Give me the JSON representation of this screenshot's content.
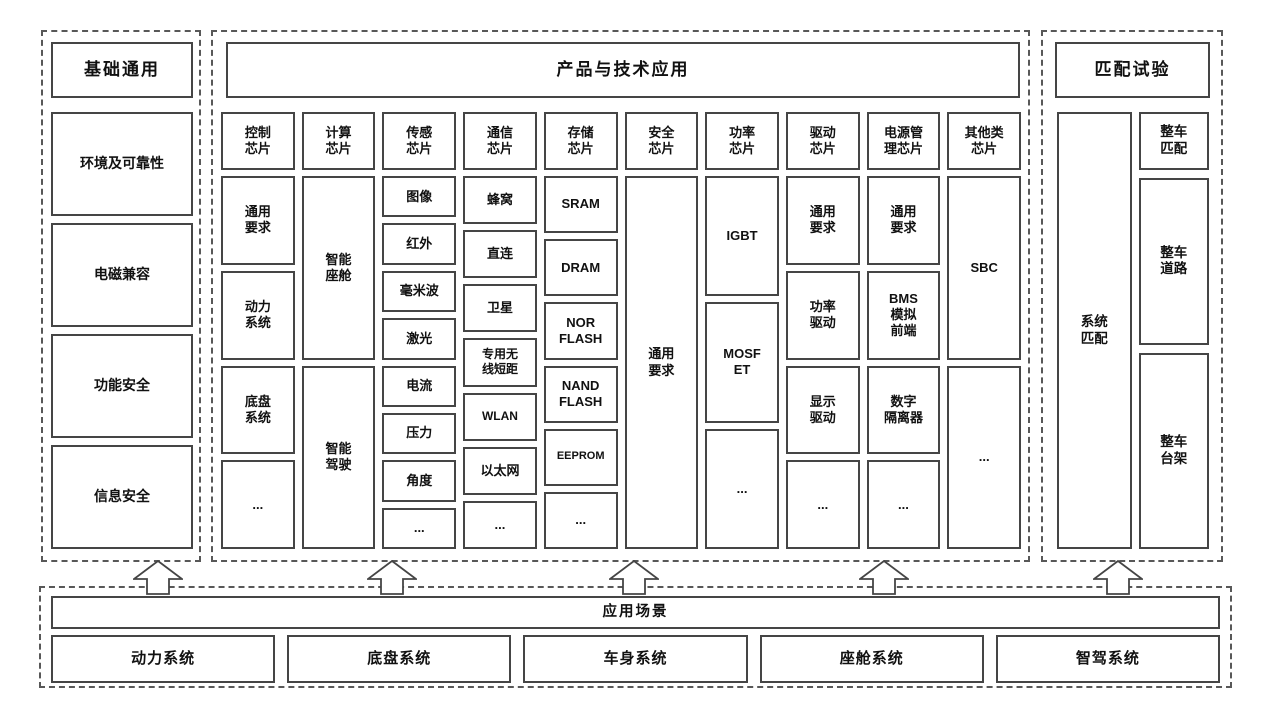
{
  "base": {
    "title": "基础通用",
    "items": [
      "环境及可靠性",
      "电磁兼容",
      "功能安全",
      "信息安全"
    ]
  },
  "products": {
    "title": "产品与技术应用",
    "columns": [
      {
        "header": "控制\n芯片",
        "items": [
          "通用\n要求",
          "动力\n系统",
          "底盘\n系统",
          "..."
        ]
      },
      {
        "header": "计算\n芯片",
        "items": [
          "智能\n座舱",
          "智能\n驾驶"
        ]
      },
      {
        "header": "传感\n芯片",
        "items": [
          "图像",
          "红外",
          "毫米波",
          "激光",
          "电流",
          "压力",
          "角度",
          "..."
        ]
      },
      {
        "header": "通信\n芯片",
        "items": [
          "蜂窝",
          "直连",
          "卫星",
          "专用无\n线短距",
          "WLAN",
          "以太网",
          "..."
        ]
      },
      {
        "header": "存储\n芯片",
        "items": [
          "SRAM",
          "DRAM",
          "NOR\nFLASH",
          "NAND\nFLASH",
          "EEPROM",
          "..."
        ]
      },
      {
        "header": "安全\n芯片",
        "items": [
          "通用\n要求"
        ]
      },
      {
        "header": "功率\n芯片",
        "items": [
          "IGBT",
          "MOSF\nET",
          "..."
        ]
      },
      {
        "header": "驱动\n芯片",
        "items": [
          "通用\n要求",
          "功率\n驱动",
          "显示\n驱动",
          "..."
        ]
      },
      {
        "header": "电源管\n理芯片",
        "items": [
          "通用\n要求",
          "BMS\n模拟\n前端",
          "数字\n隔离器",
          "..."
        ]
      },
      {
        "header": "其他类\n芯片",
        "items": [
          "SBC",
          "..."
        ]
      }
    ]
  },
  "matching": {
    "title": "匹配试验",
    "system_item": "系统\n匹配",
    "vehicle_items": [
      "整车\n匹配",
      "整车\n道路",
      "整车\n台架"
    ]
  },
  "scenarios": {
    "title": "应用场景",
    "items": [
      "动力系统",
      "底盘系统",
      "车身系统",
      "座舱系统",
      "智驾系统"
    ]
  }
}
